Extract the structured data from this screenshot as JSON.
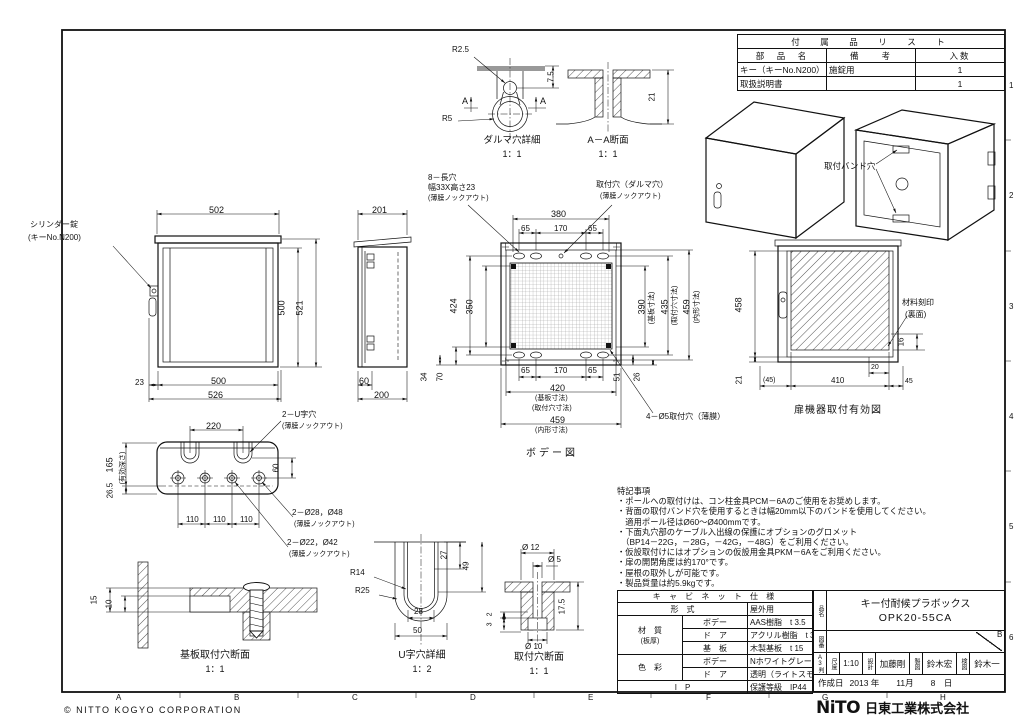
{
  "sheet": {
    "copyright": "© NITTO KOGYO CORPORATION",
    "grid_letters": [
      "A",
      "B",
      "C",
      "D",
      "E",
      "F",
      "G",
      "H"
    ],
    "grid_numbers": [
      "1",
      "2",
      "3",
      "4",
      "5",
      "6"
    ],
    "revision_mark": "B"
  },
  "logo": {
    "mark": "NiTO",
    "company": "日東工業株式会社"
  },
  "accessories": {
    "title": "付　属　品　リ　ス　ト",
    "col_part": "部　品　名",
    "col_note": "備　　考",
    "col_qty": "入数",
    "rows": [
      {
        "part": "キー（キーNo.N200）",
        "note": "施錠用",
        "qty": "1"
      },
      {
        "part": "取扱説明書",
        "note": "",
        "qty": "1"
      }
    ]
  },
  "daruma": {
    "title": "ダルマ穴詳細",
    "scale": "1：1",
    "r_small": "R2.5",
    "r_large": "R5",
    "depth": "7.5",
    "sec_a1": "A",
    "sec_a2": "A"
  },
  "aa_section": {
    "title": "A－A断面",
    "scale": "1：1",
    "height": "21"
  },
  "iso": {
    "band_hole": "取付バンド穴"
  },
  "front": {
    "lock_label1": "シリンダー錠",
    "lock_label2": "(キーNo.N200)",
    "w_roof": "502",
    "h_door": "500",
    "h_total": "521",
    "lock_off": "23",
    "w_body": "500",
    "w_total": "526"
  },
  "side": {
    "d_top": "201",
    "d_door": "60",
    "d_bottom": "200"
  },
  "body": {
    "title": "ボデー図",
    "callout_slot1": "8－長穴",
    "callout_slot2": "幅33X高さ23",
    "callout_slot3": "(薄膜ノックアウト)",
    "callout_daruma1": "取付穴（ダルマ穴）",
    "callout_daruma2": "(薄膜ノックアウト)",
    "callout_phi5": "4－Ø5取付穴（薄膜）",
    "top_380": "380",
    "top_65a": "65",
    "top_170": "170",
    "top_65b": "65",
    "left_424": "424",
    "left_350": "350",
    "bl_34": "34",
    "bl_70": "70",
    "r_390": "390",
    "r_390_note": "(基板寸法)",
    "r_435": "435",
    "r_435_note": "(取付穴寸法)",
    "r_459": "459",
    "r_459_note": "(内形寸法)",
    "br_51": "51",
    "br_26": "26",
    "bot_65a": "65",
    "bot_170": "170",
    "bot_65b": "65",
    "bot_420": "420",
    "bot_420_note1": "(基板寸法)",
    "bot_420_note2": "(取付穴寸法)",
    "bot_459": "459",
    "bot_459_note": "(内形寸法)"
  },
  "door": {
    "title": "扉機器取付有効図",
    "h_458": "458",
    "b_21": "21",
    "b_45p": "(45)",
    "b_410": "410",
    "b_45": "45",
    "b_20": "20",
    "r_16": "16",
    "stamp1": "材料刻印",
    "stamp2": "(裏面)"
  },
  "bottom": {
    "t_220": "220",
    "l_165": "165",
    "l_165_note": "(有効深さ)",
    "l_265": "26.5",
    "r_60": "60",
    "b_110a": "110",
    "b_110b": "110",
    "b_110c": "110",
    "callout_u1": "2－U字穴",
    "callout_u2": "(薄膜ノックアウト)",
    "callout_28a": "2－Ø28，Ø48",
    "callout_28b": "(薄膜ノックアウト)",
    "callout_22a": "2－Ø22，Ø42",
    "callout_22b": "(薄膜ノックアウト)"
  },
  "kiban": {
    "title": "基板取付穴断面",
    "scale": "1：1",
    "d_15": "15",
    "d_10": "10"
  },
  "u_detail": {
    "title": "U字穴詳細",
    "scale": "1：2",
    "r14": "R14",
    "r25": "R25",
    "d27": "27",
    "d49": "49",
    "d28": "28",
    "d50": "50"
  },
  "hole_section": {
    "title": "取付穴断面",
    "scale": "1：1",
    "phi12": "Ø 12",
    "phi5": "Ø 5",
    "phi10": "Ø 10",
    "d175": "17.5",
    "d2": "2",
    "d3": "3"
  },
  "notes": {
    "title": "特記事項",
    "lines": [
      "・ポールへの取付けは、コン柱金具PCM－6Aのご使用をお奨めします。",
      "・背面の取付バンド穴を使用するときは幅20mm以下のバンドを使用してください。",
      "　適用ポール径はØ60～Ø400mmです。",
      "・下面丸穴部のケーブル入出線の保護にオプションのグロメット",
      "　（BP14－22G，－28G，－42G，－48G）をご利用ください。",
      "・仮設取付けにはオプションの仮設用金具PKM－6Aをご利用ください。",
      "・扉の開閉角度は約170°です。",
      "・屋根の取外しが可能です。",
      "・製品質量は約5.9kgです。"
    ]
  },
  "spec": {
    "title": "キ ャ ビ ネ ッ ト 仕 様",
    "keishiki_label": "形　式",
    "keishiki_value": "屋外用",
    "zaishitsu_label": "材　質",
    "zaishitsu_sub": "(板厚)",
    "body_label": "ボデー",
    "body_value": "AAS樹脂　t 3.5",
    "door_label": "ド　ア",
    "door_value": "アクリル樹脂　t 3.5",
    "kiban_label": "基　板",
    "kiban_value": "木製基板　t 15",
    "color_label": "色　彩",
    "color_body_label": "ボデー",
    "color_body_value": "Nホワイトグレー色 (N8.5)",
    "color_door_label": "ド　ア",
    "color_door_value": "透明（ライトスモーク色）",
    "ip_label": "I　P",
    "ip_value": "保護等級　IP44"
  },
  "title_block": {
    "side_hinmei": "品名",
    "side_zuban": "図番",
    "side_a3": "A3判",
    "product_line1": "キー付耐候プラボックス",
    "product_line2": "OPK20-55CA",
    "scale_label": "尺度",
    "scale_value": "1:10",
    "design_label": "設計",
    "design_value": "加藤剛",
    "draft_label": "製図",
    "draft_value": "鈴木宏",
    "check_label": "検図",
    "check_value": "鈴木一",
    "date_label": "作成日",
    "date_value": "2013 年　　11月　　8　日"
  }
}
